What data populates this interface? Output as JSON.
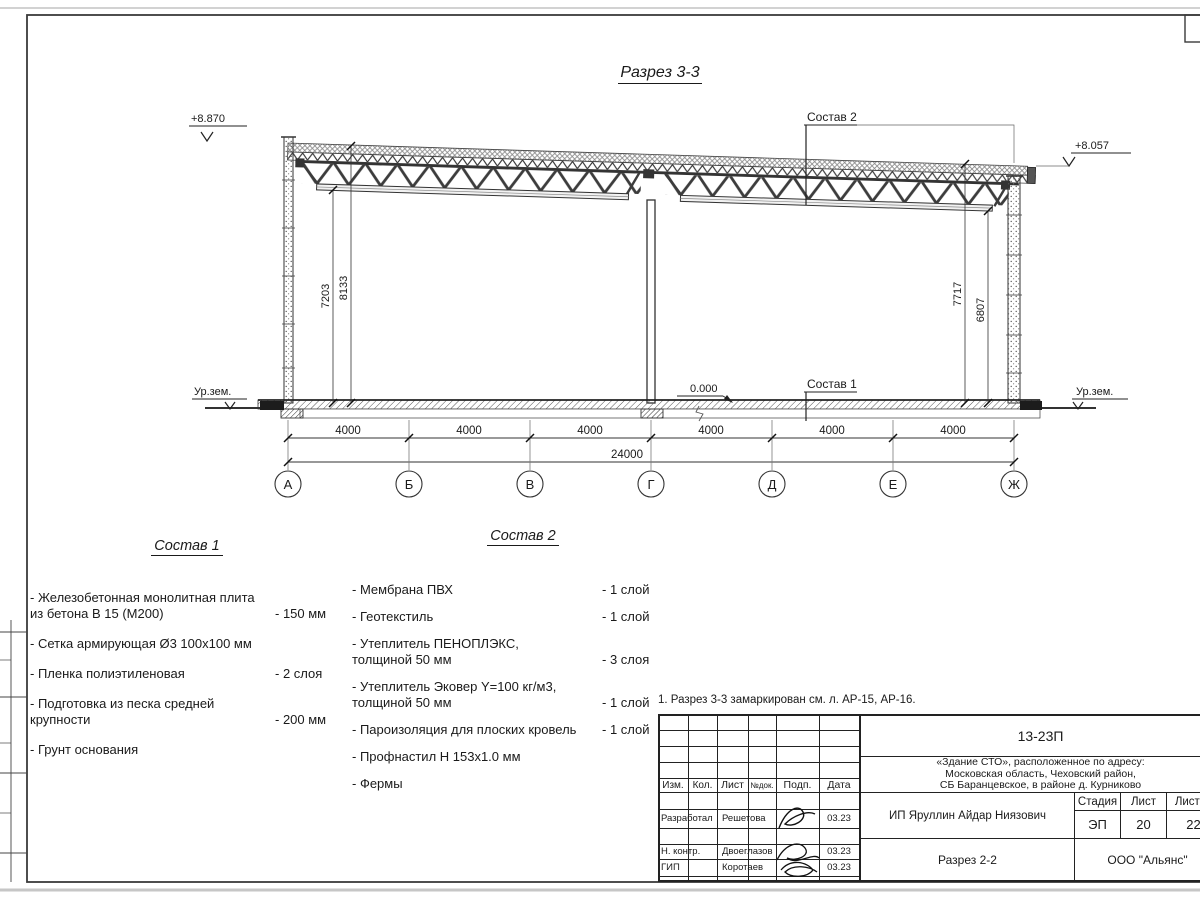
{
  "title": "Разрез 3-3",
  "section": {
    "elev_left": "+8.870",
    "elev_right": "+8.057",
    "ground_level_left": "Ур.зем.",
    "ground_level_right": "Ур.зем.",
    "zero_level": "0.000",
    "callout_roof": "Состав 2",
    "callout_floor": "Состав 1",
    "dims_left": [
      "7203",
      "8133"
    ],
    "dims_right": [
      "7717",
      "6807"
    ],
    "span_dims": [
      "4000",
      "4000",
      "4000",
      "4000",
      "4000",
      "4000"
    ],
    "total_dim": "24000",
    "axes": [
      "А",
      "Б",
      "В",
      "Г",
      "Д",
      "Е",
      "Ж"
    ]
  },
  "sostav1": {
    "title": "Состав 1",
    "items": [
      {
        "name": "- Железобетонная  монолитная плита\nиз бетона В 15 (М200)",
        "value": "- 150 мм"
      },
      {
        "name": "- Сетка армирующая Ø3 100х100 мм",
        "value": ""
      },
      {
        "name": "- Пленка полиэтиленовая",
        "value": "-  2 слоя"
      },
      {
        "name": "- Подготовка из песка средней\nкрупности",
        "value": "- 200 мм"
      },
      {
        "name": "- Грунт основания",
        "value": ""
      }
    ]
  },
  "sostav2": {
    "title": "Состав 2",
    "items": [
      {
        "name": "- Мембрана ПВХ",
        "value": "- 1 слой"
      },
      {
        "name": "- Геотекстиль",
        "value": "- 1 слой"
      },
      {
        "name": "- Утеплитель ПЕНОПЛЭКС,\nтолщиной 50 мм",
        "value": "- 3 слоя"
      },
      {
        "name": "- Утеплитель Эковер Y=100 кг/м3,\nтолщиной 50 мм",
        "value": "- 1 слой"
      },
      {
        "name": "- Пароизоляция для плоских кровель",
        "value": "- 1 слой"
      },
      {
        "name": "- Профнастил Н 153х1.0 мм",
        "value": ""
      },
      {
        "name": "- Фермы",
        "value": ""
      }
    ]
  },
  "note": "1. Разрез 3-3 замаркирован см. л. АР-15, АР-16.",
  "titleblock": {
    "doc_number": "13-23П",
    "object": "«Здание СТО», расположенное по адресу:\nМосковская область, Чеховский район,\nСБ Баранцевское, в районе д. Курниково",
    "columns": {
      "izm": "Изм.",
      "kol": "Кол.",
      "list": "Лист",
      "doc": "№док.",
      "podp": "Подп.",
      "data": "Дата"
    },
    "roles": [
      {
        "role": "Разработал",
        "name": "Решетова",
        "date": "03.23"
      },
      {
        "role": "Н. контр.",
        "name": "Двоеглазов",
        "date": "03.23"
      },
      {
        "role": "ГИП",
        "name": "Коротаев",
        "date": "03.23"
      }
    ],
    "client": "ИП Яруллин Айдар Ниязович",
    "stage_header": {
      "stage": "Стадия",
      "sheet": "Лист",
      "sheets": "Листов"
    },
    "stage_values": {
      "stage": "ЭП",
      "sheet": "20",
      "sheets": "22"
    },
    "drawing_title": "Разрез 2-2",
    "company": "ООО \"Альянс\""
  }
}
